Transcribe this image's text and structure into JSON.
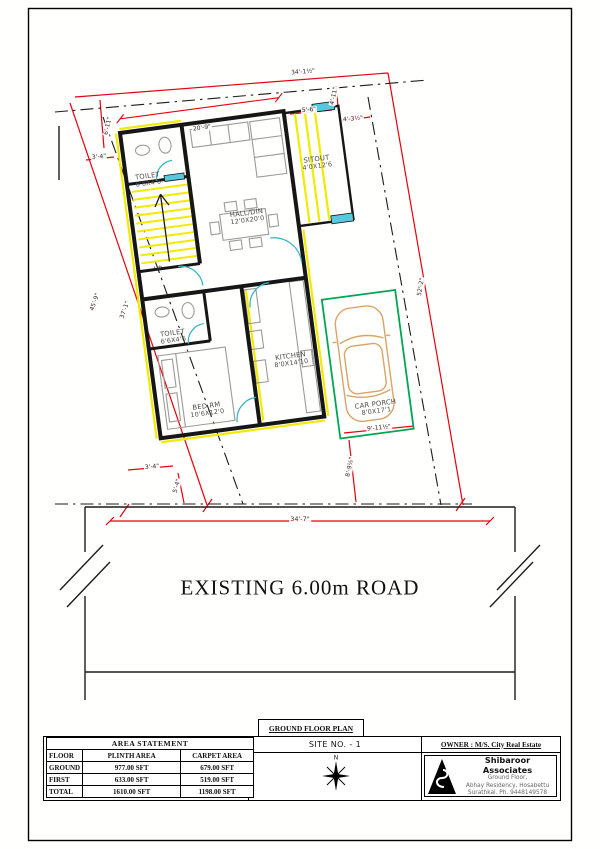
{
  "sheet": {
    "plan_label": "GROUND FLOOR PLAN"
  },
  "rooms": {
    "toilet1": {
      "name": "TOILET",
      "size": "6'6X4'6"
    },
    "hall": {
      "name": "HALL/DIN",
      "size": "12'0X20'0"
    },
    "sitout": {
      "name": "SITOUT",
      "size": "4'0X12'6"
    },
    "toilet2": {
      "name": "TOILET",
      "size": "6'6X4'6"
    },
    "bed": {
      "name": "BED RM",
      "size": "10'6X12'0"
    },
    "kitchen": {
      "name": "KITCHEN",
      "size": "8'0X14'10"
    },
    "carporch": {
      "name": "CAR PORCH",
      "size": "8'0X17'1"
    },
    "stair": "UP"
  },
  "dims": {
    "top": "34'-1½\"",
    "top_wall": "20'-9\"",
    "d5_6": "5'-6\"",
    "d4_11": "4'-11\"",
    "d4_3": "4'-3½\"",
    "d6_11": "6'-11\"",
    "d3_4_top": "3'-4\"",
    "left_outer": "45'-9\"",
    "left_inner": "37'-1\"",
    "right": "52'-2\"",
    "d3_4_bot": "3'-4\"",
    "d5_4": "5'-4\"",
    "d8_9": "8'-9½\"",
    "d9_11": "9'-11½\"",
    "bottom": "34'-7\""
  },
  "road": {
    "label": "EXISTING 6.00m ROAD"
  },
  "area_statement": {
    "title": "AREA STATEMENT",
    "headers": [
      "FLOOR",
      "PLINTH AREA",
      "CARPET AREA"
    ],
    "rows": [
      [
        "GROUND",
        "977.00 SFT",
        "679.00 SFT"
      ],
      [
        "FIRST",
        "633.00 SFT",
        "519.00 SFT"
      ],
      [
        "TOTAL",
        "1610.00 SFT",
        "1198.00 SFT"
      ]
    ]
  },
  "title_block": {
    "site_no": "SITE NO. - 1",
    "owner": "OWNER : M/S. City Real Estate",
    "firm_name": "Shibaroor Associates",
    "firm_line1": "Ground Floor,",
    "firm_line2": "Abhay Residency, Hosabettu",
    "firm_line3": "Surathkal.   Ph. 9448149578",
    "north": "N"
  },
  "colors": {
    "dimension_red": "#e8000d",
    "highlight_yellow": "#f2ea00",
    "door_teal": "#2fb3bf",
    "porch_green": "#00a651",
    "car_tan": "#d8a468"
  }
}
